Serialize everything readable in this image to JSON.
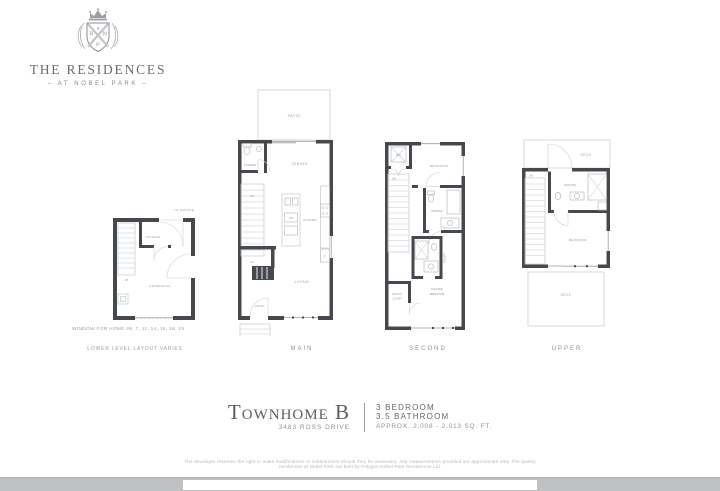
{
  "logo": {
    "title": "THE RESIDENCES",
    "tagline": "–  AT NOBEL PARK  –",
    "monogram_left": "R",
    "monogram_right": "N",
    "monogram_bottom": "P"
  },
  "plans": {
    "lower": {
      "to_garage": "TO GARAGE",
      "up": "UP",
      "storage": "STORAGE",
      "recreation": "RECREATION",
      "note_window": "WINDOW FOR HOME #6, 7, 11, 14, 15, 18, 19",
      "note_layout": "LOWER LEVEL LAYOUT VARIES"
    },
    "main": {
      "label": "MAIN",
      "patio": "PATIO",
      "powder": "POWDER",
      "dining": "DINING",
      "dn": "DN",
      "up": "UP",
      "kitchen": "KITCHEN",
      "dw": "DW",
      "fridge": "F",
      "living": "LIVING",
      "entry": "ENTRY"
    },
    "second": {
      "label": "SECOND",
      "wd": "W/D",
      "bedroom": "BEDROOM",
      "dn": "DN",
      "ensuite": "ENSUITE",
      "ensuite2": "ENSUITE",
      "master_line1": "MASTER",
      "master_line2": "BEDROOM",
      "walkin_line1": "WALK-IN",
      "walkin_line2": "CLOSET"
    },
    "upper": {
      "label": "UPPER",
      "deck_top": "DECK",
      "dn": "DN",
      "ensuite": "ENSUITE",
      "bedroom": "BEDROOM",
      "deck_bottom": "DECK"
    }
  },
  "title_block": {
    "title": "Townhome B",
    "address": "3483 ROSS DRIVE",
    "bedrooms": "3 BEDROOM",
    "bathrooms": "3.5 BATHROOM",
    "area": "APPROX. 2,008 - 2,013 SQ. FT."
  },
  "disclaimer": "The developer reserves the right to make modifications or substitutions should they be necessary. Any measurements provided are approximate only. The quality residences at Nobel Park are built by Polygon Nobel Park Residences Ltd.",
  "colors": {
    "wall": "#45484c",
    "thin_line": "#c6c8ca",
    "room_label": "#97999d",
    "heading": "#5a5d64",
    "muted": "#8e9196",
    "page_edge": "#bfc1c3"
  }
}
